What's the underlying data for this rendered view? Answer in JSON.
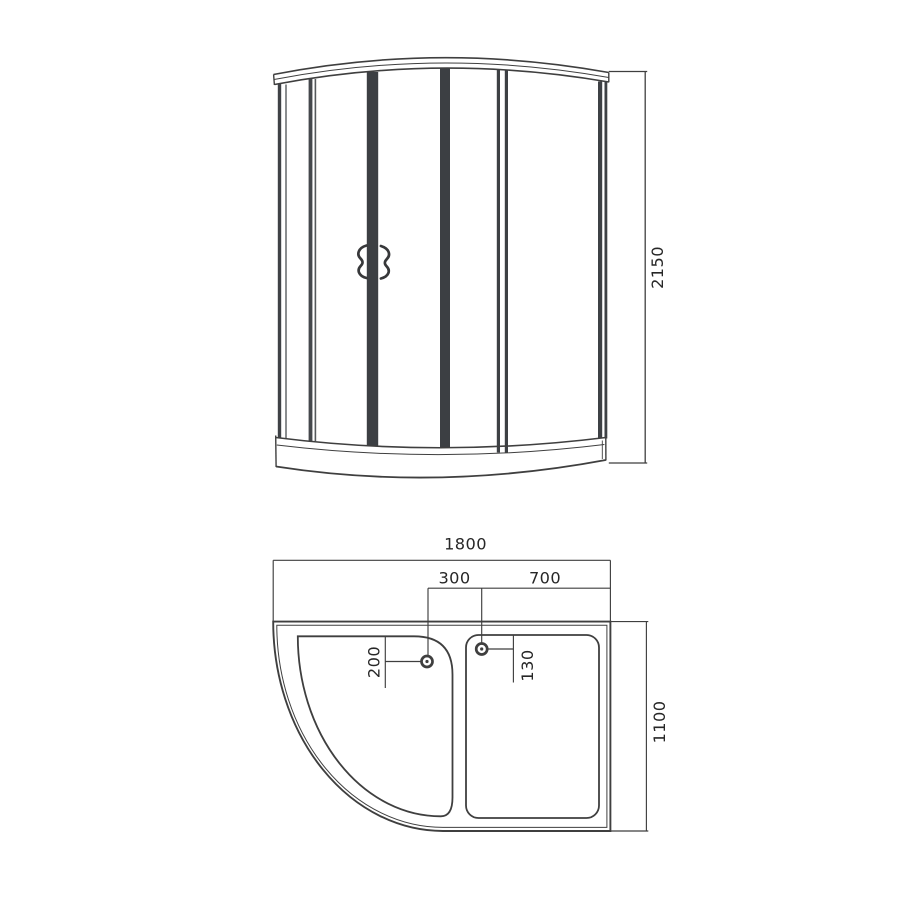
{
  "colors": {
    "line": "#3f3f3f",
    "dark_profile_fill": "#3c3f43",
    "text": "#272727",
    "background": "#ffffff"
  },
  "front_view": {
    "height_dim_label": "2150"
  },
  "plan_view": {
    "width_dim_label": "1800",
    "drain_spacing_dim_label": "300",
    "right_section_width_dim_label": "700",
    "left_drain_offset_dim_label": "200",
    "right_drain_offset_dim_label": "130",
    "depth_dim_label": "1100"
  }
}
